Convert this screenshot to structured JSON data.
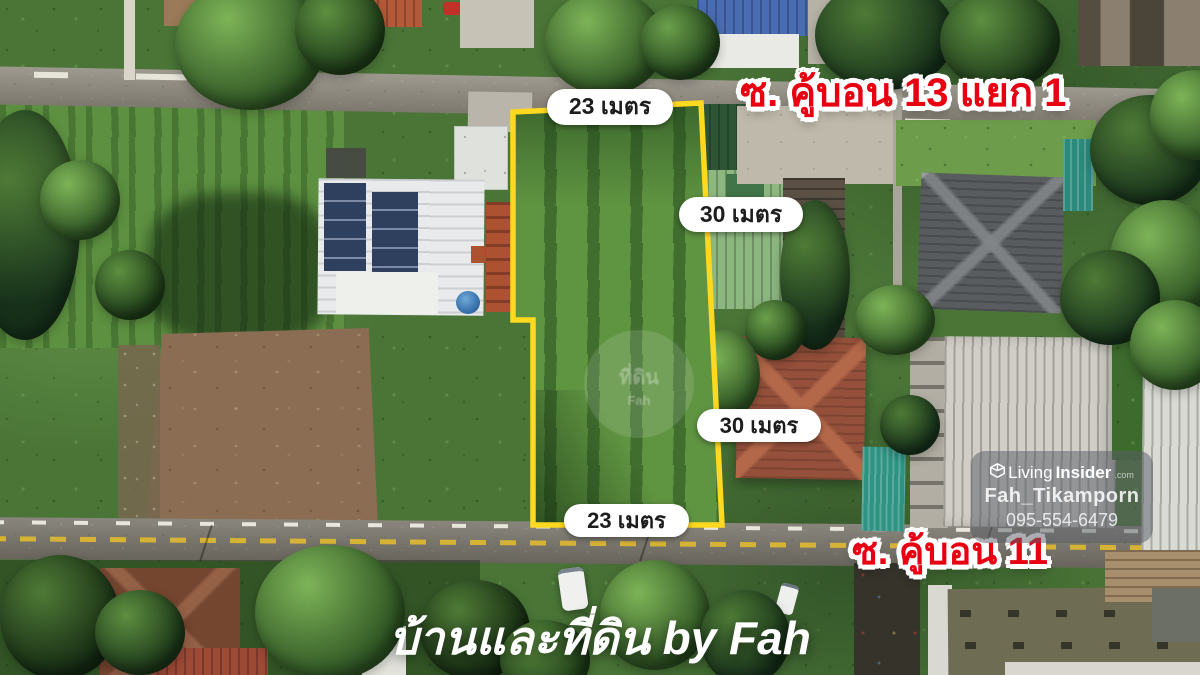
{
  "overlay": {
    "street_top": "ซ. คู้บอน 13 แยก 1",
    "street_bottom": "ซ. คู้บอน 11",
    "dim_top": "23 เมตร",
    "dim_right_upper": "30 เมตร",
    "dim_right_lower": "30 เมตร",
    "dim_bottom": "23 เมตร",
    "footer_watermark": "บ้านและที่ดิน by Fah",
    "circle_watermark_line1": "ที่ดิน",
    "circle_watermark_line2": "Fah"
  },
  "branding": {
    "brand_light": "Living",
    "brand_bold": "Insider",
    "brand_suffix": ".com",
    "agent": "Fah_Tikamporn",
    "phone": "095-554-6479"
  },
  "colors": {
    "plot_outline": "#ffd91f",
    "street_label": "#e80012",
    "pill_bg": "#ffffff",
    "pill_text": "#1d1d1d",
    "watermark": "#ffffff"
  }
}
